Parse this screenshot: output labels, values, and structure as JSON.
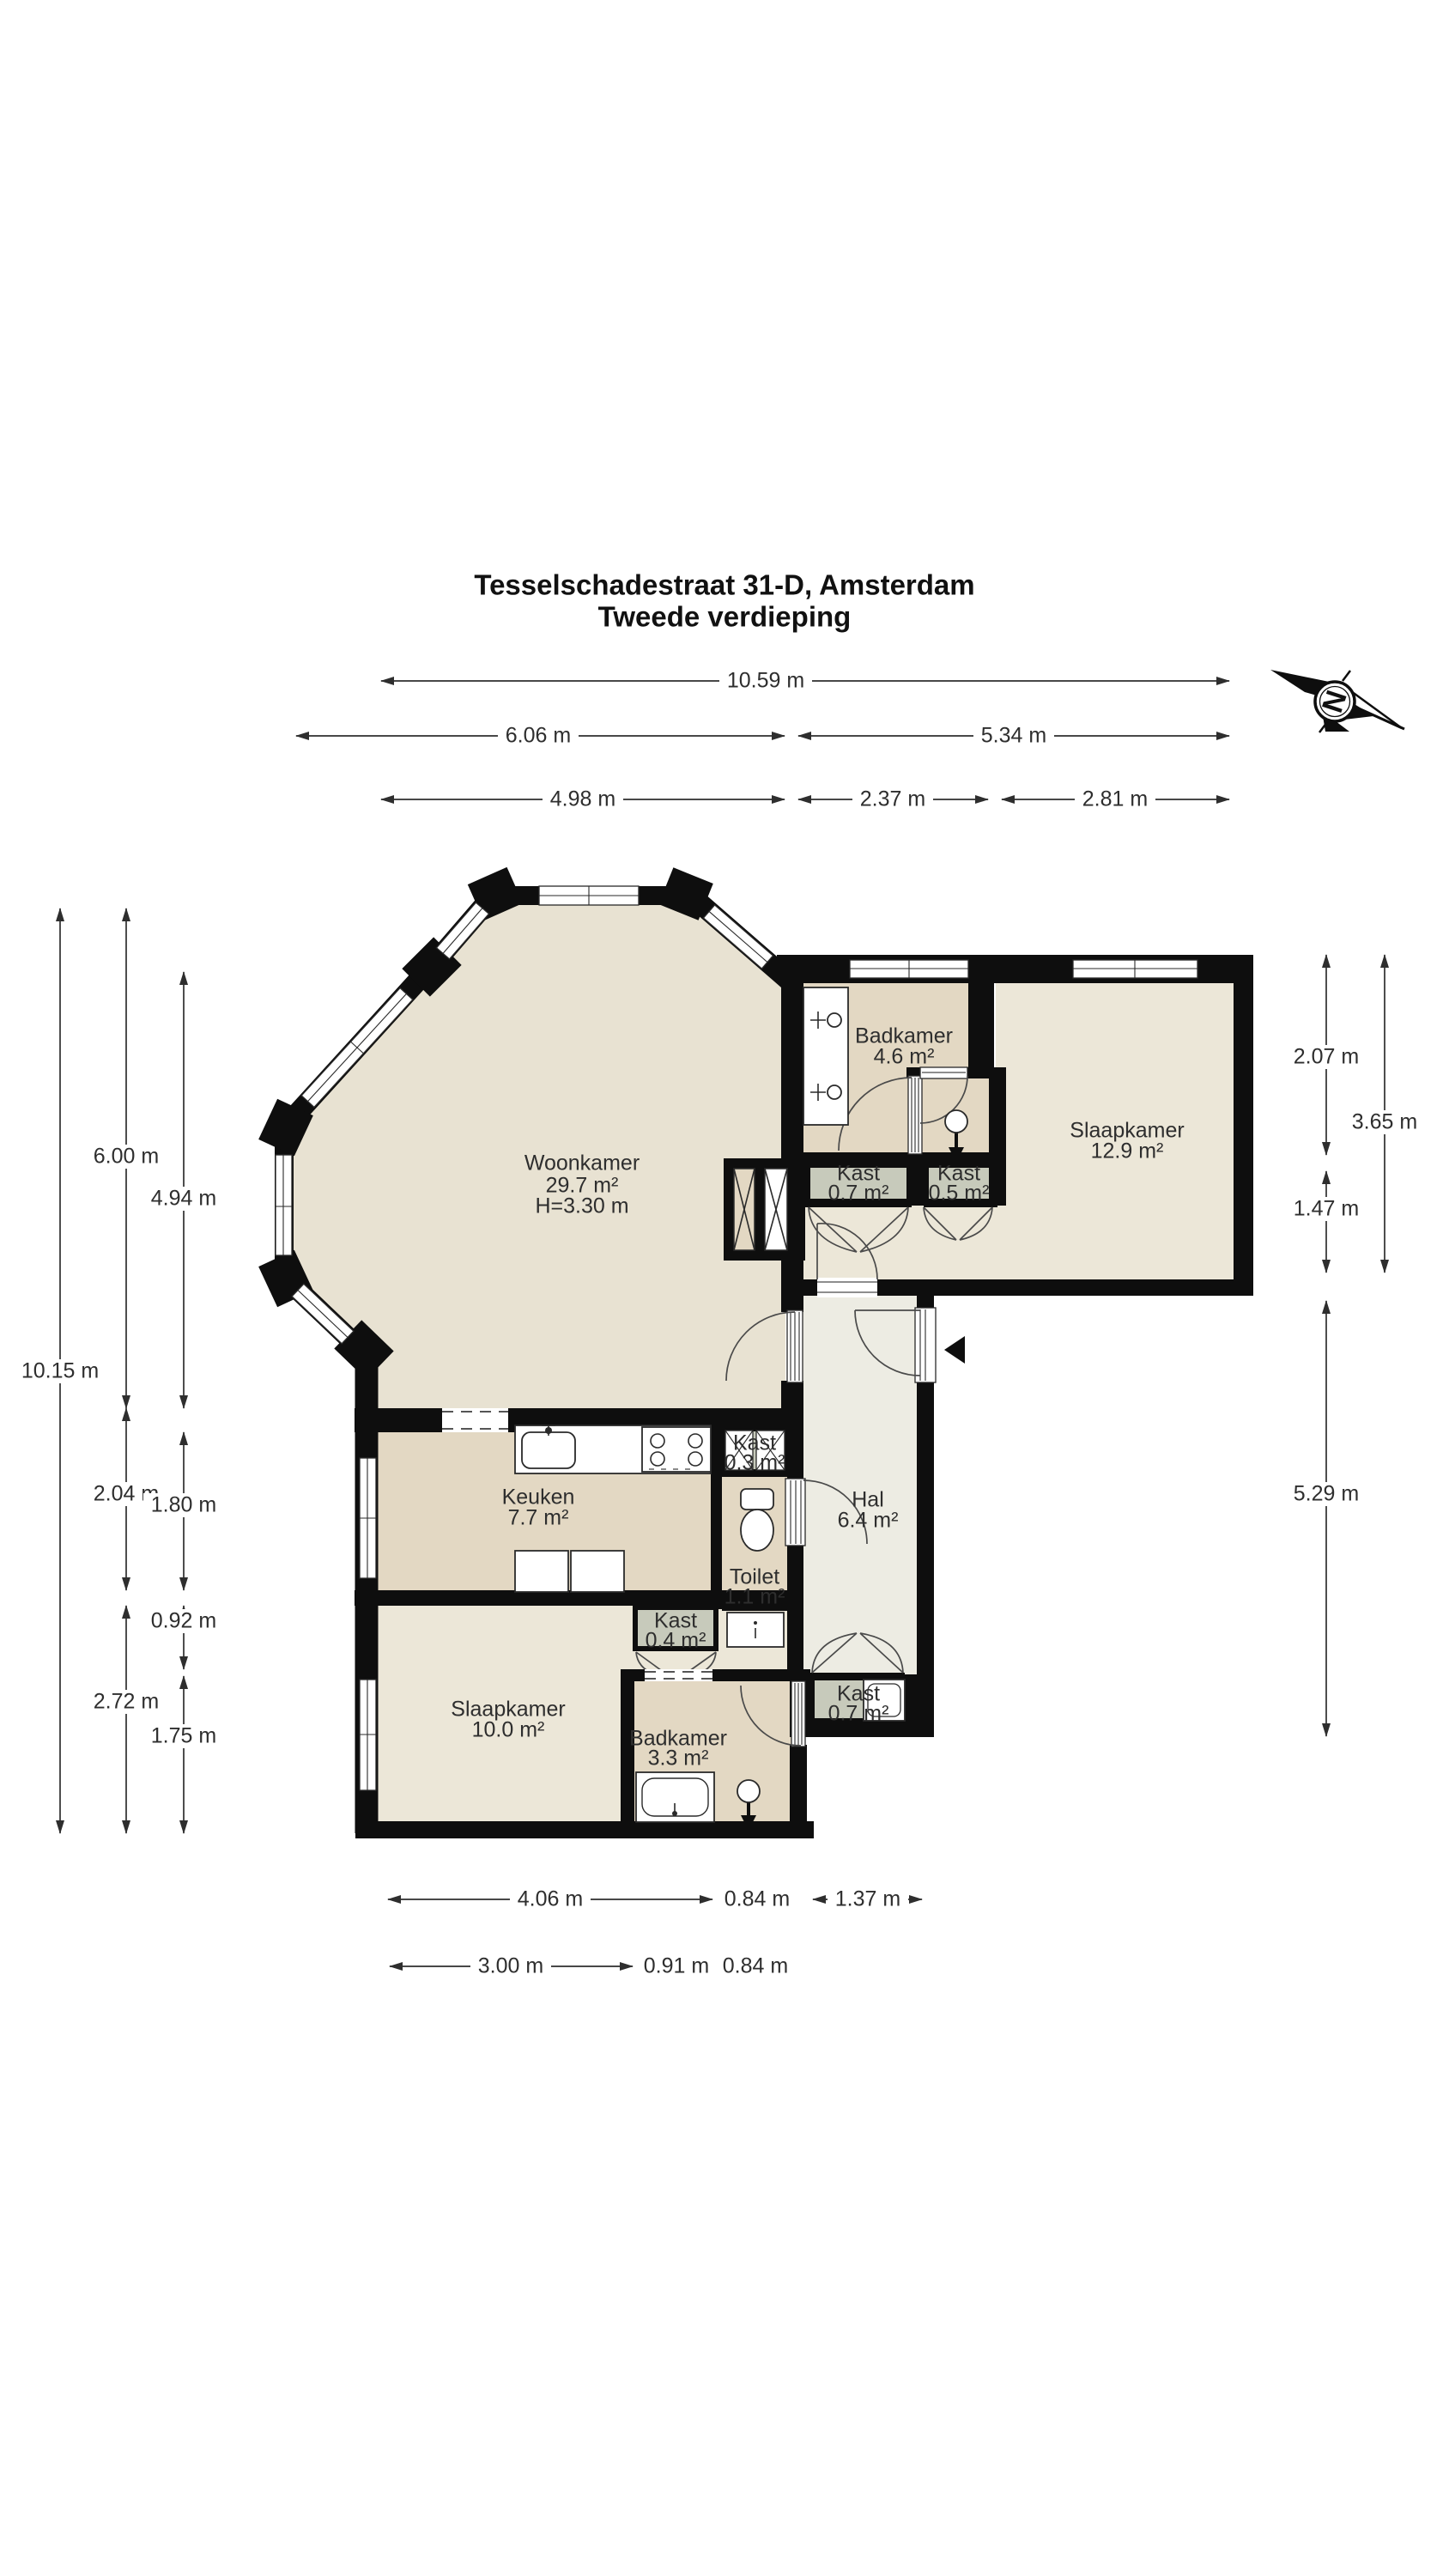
{
  "title": {
    "line1": "Tesselschadestraat 31-D, Amsterdam",
    "line2": "Tweede verdieping"
  },
  "compass": {
    "label": "N"
  },
  "rooms": {
    "woonkamer": {
      "name": "Woonkamer",
      "area": "29.7 m²",
      "height": "H=3.30 m"
    },
    "badkamer_boven": {
      "name": "Badkamer",
      "area": "4.6 m²"
    },
    "slaapkamer_groot": {
      "name": "Slaapkamer",
      "area": "12.9 m²"
    },
    "kast_07_boven": {
      "name": "Kast",
      "area": "0.7 m²"
    },
    "kast_05": {
      "name": "Kast",
      "area": "0.5 m²"
    },
    "keuken": {
      "name": "Keuken",
      "area": "7.7 m²"
    },
    "kast_03": {
      "name": "Kast",
      "area": "0.3 m²"
    },
    "hal": {
      "name": "Hal",
      "area": "6.4 m²"
    },
    "toilet": {
      "name": "Toilet",
      "area": "1.1 m²"
    },
    "kast_04": {
      "name": "Kast",
      "area": "0.4 m²"
    },
    "slaapkamer_klein": {
      "name": "Slaapkamer",
      "area": "10.0 m²"
    },
    "badkamer_beneden": {
      "name": "Badkamer",
      "area": "3.3 m²"
    },
    "kast_07_onder": {
      "name": "Kast",
      "area": "0.7 m²"
    }
  },
  "dims": {
    "top": [
      "10.59 m",
      "6.06 m",
      "5.34 m",
      "4.98 m",
      "2.37 m",
      "2.81 m"
    ],
    "left": [
      "6.00 m",
      "4.94 m",
      "10.15 m",
      "2.04 m",
      "1.80 m",
      "0.92 m",
      "2.72 m",
      "1.75 m"
    ],
    "right": [
      "2.07 m",
      "3.65 m",
      "1.47 m",
      "5.29 m"
    ],
    "bottom": [
      "4.06 m",
      "0.84 m",
      "1.37 m",
      "3.00 m",
      "0.91 m",
      "0.84 m"
    ]
  },
  "colors": {
    "wall": "#0e0e0e",
    "room_tan": "#e3d8c3",
    "room_light": "#e8e2d2",
    "bedroom": "#ece7d8",
    "hall": "#edece3",
    "closet_gray": "#c7cabb"
  }
}
